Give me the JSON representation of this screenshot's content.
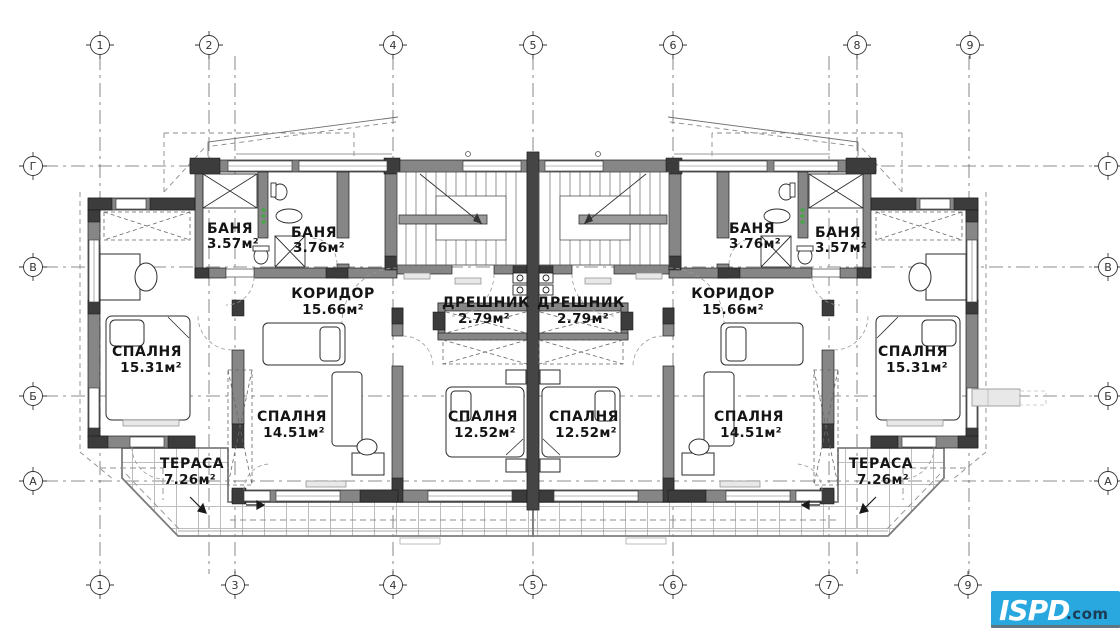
{
  "drawing": {
    "type": "architectural-floor-plan",
    "language": "Bulgarian"
  },
  "grid": {
    "top": [
      "1",
      "2",
      "4",
      "5",
      "6",
      "8",
      "9"
    ],
    "bottom": [
      "1",
      "3",
      "4",
      "5",
      "6",
      "7",
      "9"
    ],
    "left": [
      "Г",
      "В",
      "Б",
      "А"
    ],
    "right": [
      "Г",
      "В",
      "Б",
      "А"
    ]
  },
  "rooms": [
    {
      "name": "БАНЯ",
      "area": "3.57м²"
    },
    {
      "name": "БАНЯ",
      "area": "3.76м²"
    },
    {
      "name": "БАНЯ",
      "area": "3.76м²"
    },
    {
      "name": "БАНЯ",
      "area": "3.57м²"
    },
    {
      "name": "КОРИДОР",
      "area": "15.66м²"
    },
    {
      "name": "КОРИДОР",
      "area": "15.66м²"
    },
    {
      "name": "ДРЕШНИК",
      "area": "2.79м²"
    },
    {
      "name": "ДРЕШНИК",
      "area": "2.79м²"
    },
    {
      "name": "СПАЛНЯ",
      "area": "15.31м²"
    },
    {
      "name": "СПАЛНЯ",
      "area": "15.31м²"
    },
    {
      "name": "СПАЛНЯ",
      "area": "14.51м²"
    },
    {
      "name": "СПАЛНЯ",
      "area": "14.51м²"
    },
    {
      "name": "СПАЛНЯ",
      "area": "12.52м²"
    },
    {
      "name": "СПАЛНЯ",
      "area": "12.52м²"
    },
    {
      "name": "ТЕРАСА",
      "area": "7.26м²"
    },
    {
      "name": "ТЕРАСА",
      "area": "7.26м²"
    }
  ],
  "logo": {
    "brand": "ISPD",
    "tld": ".com",
    "bg": "#29a8e0",
    "brand_color": "#ffffff",
    "tld_color": "#1b3c55"
  },
  "colors": {
    "wall": "#868686",
    "wall_dark": "#3c3c3c",
    "grid_line": "#5a5a5a",
    "hatch": "#b8b8b8",
    "fixture_green": "#4aa54a"
  }
}
